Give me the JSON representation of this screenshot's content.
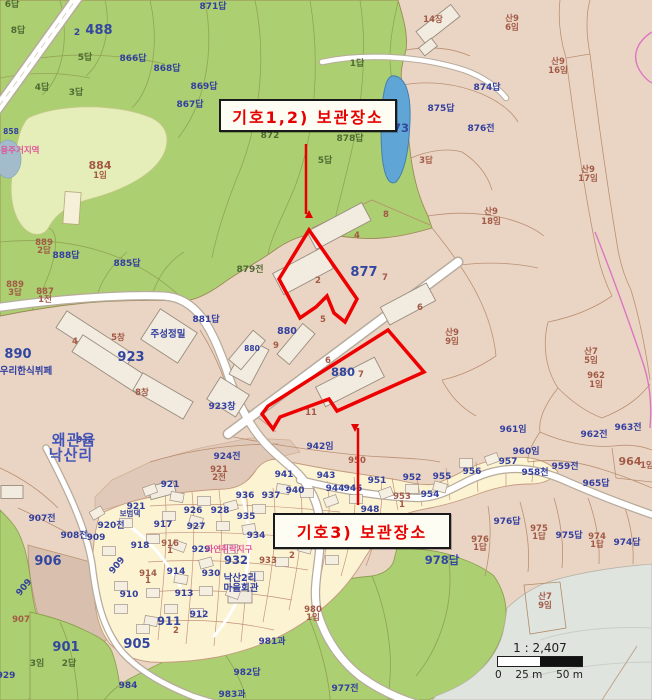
{
  "map": {
    "highlight_color": "#ee0000",
    "annotations": {
      "box1": {
        "text": "기호1,2) 보관장소",
        "x": 219,
        "y": 99,
        "w": 174,
        "h": 29
      },
      "box2": {
        "text": "기호3) 보관장소",
        "x": 273,
        "y": 513,
        "w": 174,
        "h": 32
      },
      "arrow_color": "#e60000",
      "arrows": [
        {
          "x1": 306,
          "y1": 144,
          "x2": 306,
          "y2": 214
        },
        {
          "x1": 358,
          "y1": 505,
          "x2": 358,
          "y2": 428
        }
      ]
    },
    "highlights": [
      {
        "name": "storage-site-1-2",
        "points": "309,230 357,299 345,322 334,313 327,296 316,307 300,318 279,279"
      },
      {
        "name": "storage-site-3",
        "points": "388,330 424,372 337,411 329,399 280,417 273,429 262,414 268,406"
      }
    ],
    "scale_bar": {
      "ratio": "1 : 2,407",
      "tick0": "0",
      "tick25": "25 m",
      "tick50": "50 m"
    },
    "colors": {
      "base_tan": "#ead5c5",
      "forest_green": "#accf72",
      "light_green": "#e5edb8",
      "village_cream": "#fbf3d2",
      "pond_blue": "#5fa5d5",
      "gray_zone": "#e0e4df",
      "parcel_line": "#b5896a",
      "label_blue": "#333f9e",
      "label_brown": "#a25a46",
      "zone_pink": "#e0559a",
      "road_white": "#ffffff"
    },
    "labels": [
      {
        "t": "6답",
        "x": 12,
        "y": 7,
        "c": "o"
      },
      {
        "t": "8답",
        "x": 18,
        "y": 33,
        "c": "o"
      },
      {
        "t": "2",
        "x": 77,
        "y": 35,
        "c": "b"
      },
      {
        "t": "488",
        "x": 99,
        "y": 34,
        "c": "B"
      },
      {
        "t": "866답",
        "x": 133,
        "y": 61,
        "c": "b"
      },
      {
        "t": "868답",
        "x": 167,
        "y": 71,
        "c": "b"
      },
      {
        "t": "871답",
        "x": 213,
        "y": 9,
        "c": "b"
      },
      {
        "t": "869답",
        "x": 204,
        "y": 89,
        "c": "b"
      },
      {
        "t": "867답",
        "x": 190,
        "y": 107,
        "c": "b"
      },
      {
        "t": "5답",
        "x": 85,
        "y": 60,
        "c": "o"
      },
      {
        "t": "4답",
        "x": 42,
        "y": 90,
        "c": "o"
      },
      {
        "t": "3답",
        "x": 76,
        "y": 95,
        "c": "o"
      },
      {
        "t": "858",
        "x": 11,
        "y": 134,
        "c": "t"
      },
      {
        "t": "전용주거지역",
        "x": 16,
        "y": 153,
        "c": "p"
      },
      {
        "t": "884",
        "x": 100,
        "y": 169,
        "c": "R"
      },
      {
        "t": "1임",
        "x": 100,
        "y": 178,
        "c": "r"
      },
      {
        "t": "1답",
        "x": 357,
        "y": 66,
        "c": "o"
      },
      {
        "t": "872",
        "x": 270,
        "y": 138,
        "c": "o"
      },
      {
        "t": "878답",
        "x": 350,
        "y": 141,
        "c": "o"
      },
      {
        "t": "5답",
        "x": 325,
        "y": 163,
        "c": "o"
      },
      {
        "t": "879전",
        "x": 250,
        "y": 272,
        "c": "o"
      },
      {
        "t": "889",
        "x": 44,
        "y": 245,
        "c": "r"
      },
      {
        "t": "2답",
        "x": 44,
        "y": 253,
        "c": "r"
      },
      {
        "t": "888답",
        "x": 66,
        "y": 258,
        "c": "b"
      },
      {
        "t": "885답",
        "x": 127,
        "y": 266,
        "c": "b"
      },
      {
        "t": "889",
        "x": 15,
        "y": 287,
        "c": "r"
      },
      {
        "t": "3답",
        "x": 15,
        "y": 295,
        "c": "r"
      },
      {
        "t": "887",
        "x": 45,
        "y": 294,
        "c": "r"
      },
      {
        "t": "1전",
        "x": 45,
        "y": 302,
        "c": "r"
      },
      {
        "t": "890",
        "x": 18,
        "y": 358,
        "c": "B"
      },
      {
        "t": "우리한식뷔페",
        "x": 26,
        "y": 374,
        "c": "w"
      },
      {
        "t": "14장",
        "x": 433,
        "y": 22,
        "c": "r"
      },
      {
        "t": "산9",
        "x": 512,
        "y": 21,
        "c": "r"
      },
      {
        "t": "6임",
        "x": 512,
        "y": 30,
        "c": "r"
      },
      {
        "t": "산9",
        "x": 558,
        "y": 64,
        "c": "r"
      },
      {
        "t": "16임",
        "x": 558,
        "y": 73,
        "c": "r"
      },
      {
        "t": "산9",
        "x": 588,
        "y": 172,
        "c": "r"
      },
      {
        "t": "17임",
        "x": 588,
        "y": 181,
        "c": "r"
      },
      {
        "t": "874답",
        "x": 487,
        "y": 90,
        "c": "b"
      },
      {
        "t": "875답",
        "x": 441,
        "y": 111,
        "c": "b"
      },
      {
        "t": "876전",
        "x": 481,
        "y": 131,
        "c": "b"
      },
      {
        "t": "873",
        "x": 397,
        "y": 132,
        "c": "B2"
      },
      {
        "t": "3답",
        "x": 426,
        "y": 163,
        "c": "r"
      },
      {
        "t": "산9",
        "x": 491,
        "y": 214,
        "c": "r"
      },
      {
        "t": "18임",
        "x": 491,
        "y": 224,
        "c": "r"
      },
      {
        "t": "산7",
        "x": 591,
        "y": 354,
        "c": "r"
      },
      {
        "t": "5임",
        "x": 591,
        "y": 363,
        "c": "r"
      },
      {
        "t": "8",
        "x": 386,
        "y": 217,
        "c": "r"
      },
      {
        "t": "4",
        "x": 357,
        "y": 238,
        "c": "r"
      },
      {
        "t": "2",
        "x": 318,
        "y": 283,
        "c": "r"
      },
      {
        "t": "877",
        "x": 364,
        "y": 276,
        "c": "B"
      },
      {
        "t": "7",
        "x": 385,
        "y": 280,
        "c": "r"
      },
      {
        "t": "5",
        "x": 323,
        "y": 322,
        "c": "r"
      },
      {
        "t": "6",
        "x": 420,
        "y": 310,
        "c": "r"
      },
      {
        "t": "880",
        "x": 287,
        "y": 334,
        "c": "w"
      },
      {
        "t": "880",
        "x": 252,
        "y": 351,
        "c": "t"
      },
      {
        "t": "9",
        "x": 276,
        "y": 348,
        "c": "r"
      },
      {
        "t": "881답",
        "x": 206,
        "y": 322,
        "c": "b"
      },
      {
        "t": "923",
        "x": 131,
        "y": 361,
        "c": "B"
      },
      {
        "t": "주성정밀",
        "x": 168,
        "y": 337,
        "c": "w"
      },
      {
        "t": "4",
        "x": 75,
        "y": 344,
        "c": "r"
      },
      {
        "t": "5창",
        "x": 118,
        "y": 340,
        "c": "r"
      },
      {
        "t": "8창",
        "x": 142,
        "y": 395,
        "c": "r"
      },
      {
        "t": "923창",
        "x": 222,
        "y": 409,
        "c": "b"
      },
      {
        "t": "880",
        "x": 343,
        "y": 376,
        "c": "B2"
      },
      {
        "t": "7",
        "x": 361,
        "y": 377,
        "c": "r"
      },
      {
        "t": "6",
        "x": 328,
        "y": 363,
        "c": "r"
      },
      {
        "t": "11",
        "x": 311,
        "y": 415,
        "c": "r"
      },
      {
        "t": "942임",
        "x": 320,
        "y": 449,
        "c": "b"
      },
      {
        "t": "산9",
        "x": 452,
        "y": 335,
        "c": "r"
      },
      {
        "t": "9임",
        "x": 452,
        "y": 344,
        "c": "r"
      },
      {
        "t": "962",
        "x": 596,
        "y": 378,
        "c": "r"
      },
      {
        "t": "1임",
        "x": 596,
        "y": 387,
        "c": "r"
      },
      {
        "t": "962전",
        "x": 594,
        "y": 437,
        "c": "b"
      },
      {
        "t": "963전",
        "x": 628,
        "y": 430,
        "c": "b"
      },
      {
        "t": "964",
        "x": 630,
        "y": 465,
        "c": "R"
      },
      {
        "t": "1임",
        "x": 647,
        "y": 468,
        "c": "r"
      },
      {
        "t": "965답",
        "x": 596,
        "y": 486,
        "c": "b"
      },
      {
        "t": "959전",
        "x": 565,
        "y": 469,
        "c": "b"
      },
      {
        "t": "960임",
        "x": 526,
        "y": 454,
        "c": "b"
      },
      {
        "t": "961임",
        "x": 513,
        "y": 432,
        "c": "b"
      },
      {
        "t": "957",
        "x": 508,
        "y": 464,
        "c": "b"
      },
      {
        "t": "958천",
        "x": 535,
        "y": 475,
        "c": "b"
      },
      {
        "t": "956",
        "x": 472,
        "y": 474,
        "c": "b"
      },
      {
        "t": "955",
        "x": 442,
        "y": 479,
        "c": "b"
      },
      {
        "t": "954",
        "x": 430,
        "y": 497,
        "c": "b"
      },
      {
        "t": "952",
        "x": 412,
        "y": 480,
        "c": "b"
      },
      {
        "t": "953",
        "x": 402,
        "y": 499,
        "c": "r"
      },
      {
        "t": "1",
        "x": 402,
        "y": 507,
        "c": "r"
      },
      {
        "t": "951",
        "x": 377,
        "y": 483,
        "c": "b"
      },
      {
        "t": "950",
        "x": 357,
        "y": 463,
        "c": "r"
      },
      {
        "t": "948",
        "x": 370,
        "y": 512,
        "c": "b"
      },
      {
        "t": "945",
        "x": 353,
        "y": 491,
        "c": "b"
      },
      {
        "t": "944",
        "x": 335,
        "y": 491,
        "c": "b"
      },
      {
        "t": "943",
        "x": 326,
        "y": 478,
        "c": "b"
      },
      {
        "t": "941",
        "x": 284,
        "y": 477,
        "c": "b"
      },
      {
        "t": "940",
        "x": 295,
        "y": 493,
        "c": "b"
      },
      {
        "t": "937",
        "x": 271,
        "y": 498,
        "c": "b"
      },
      {
        "t": "936",
        "x": 245,
        "y": 498,
        "c": "b"
      },
      {
        "t": "935",
        "x": 246,
        "y": 519,
        "c": "b"
      },
      {
        "t": "934",
        "x": 256,
        "y": 538,
        "c": "b"
      },
      {
        "t": "939",
        "x": 289,
        "y": 541,
        "c": "b"
      },
      {
        "t": "928",
        "x": 220,
        "y": 513,
        "c": "b"
      },
      {
        "t": "926",
        "x": 193,
        "y": 513,
        "c": "b"
      },
      {
        "t": "927",
        "x": 196,
        "y": 529,
        "c": "b"
      },
      {
        "t": "917",
        "x": 163,
        "y": 527,
        "c": "b"
      },
      {
        "t": "916",
        "x": 170,
        "y": 546,
        "c": "r"
      },
      {
        "t": "1",
        "x": 170,
        "y": 553,
        "c": "r"
      },
      {
        "t": "918",
        "x": 140,
        "y": 548,
        "c": "b"
      },
      {
        "t": "929",
        "x": 201,
        "y": 552,
        "c": "b"
      },
      {
        "t": "자연취락지구",
        "x": 229,
        "y": 552,
        "c": "p"
      },
      {
        "t": "932",
        "x": 236,
        "y": 564,
        "c": "B2"
      },
      {
        "t": "933",
        "x": 268,
        "y": 563,
        "c": "r"
      },
      {
        "t": "2",
        "x": 292,
        "y": 558,
        "c": "r"
      },
      {
        "t": "930",
        "x": 211,
        "y": 576,
        "c": "b"
      },
      {
        "t": "낙산2리",
        "x": 240,
        "y": 581,
        "c": "w"
      },
      {
        "t": "마을회관",
        "x": 241,
        "y": 591,
        "c": "w"
      },
      {
        "t": "914",
        "x": 148,
        "y": 576,
        "c": "r"
      },
      {
        "t": "1",
        "x": 148,
        "y": 583,
        "c": "r"
      },
      {
        "t": "914",
        "x": 176,
        "y": 574,
        "c": "b"
      },
      {
        "t": "913",
        "x": 184,
        "y": 596,
        "c": "b"
      },
      {
        "t": "910",
        "x": 129,
        "y": 597,
        "c": "b"
      },
      {
        "t": "912",
        "x": 199,
        "y": 617,
        "c": "b"
      },
      {
        "t": "911",
        "x": 169,
        "y": 625,
        "c": "B2"
      },
      {
        "t": "2",
        "x": 176,
        "y": 633,
        "c": "r"
      },
      {
        "t": "905",
        "x": 137,
        "y": 648,
        "c": "B"
      },
      {
        "t": "907",
        "x": 21,
        "y": 622,
        "c": "r"
      },
      {
        "t": "906",
        "x": 48,
        "y": 565,
        "c": "B"
      },
      {
        "t": "924전",
        "x": 227,
        "y": 459,
        "c": "b"
      },
      {
        "t": "921",
        "x": 219,
        "y": 472,
        "c": "r"
      },
      {
        "t": "2전",
        "x": 219,
        "y": 480,
        "c": "r"
      },
      {
        "t": "921",
        "x": 170,
        "y": 487,
        "c": "b"
      },
      {
        "t": "921",
        "x": 136,
        "y": 509,
        "c": "b"
      },
      {
        "t": "보범댁",
        "x": 130,
        "y": 516,
        "c": "t"
      },
      {
        "t": "932",
        "x": 85,
        "y": 442,
        "c": "t"
      },
      {
        "t": "왜관읍",
        "x": 74,
        "y": 445,
        "c": "P"
      },
      {
        "t": "낙산리",
        "x": 71,
        "y": 460,
        "c": "P"
      },
      {
        "t": "907전",
        "x": 42,
        "y": 521,
        "c": "b"
      },
      {
        "t": "908전",
        "x": 74,
        "y": 538,
        "c": "b"
      },
      {
        "t": "909",
        "x": 96,
        "y": 540,
        "c": "b"
      },
      {
        "t": "920전",
        "x": 111,
        "y": 528,
        "c": "b"
      },
      {
        "t": "909",
        "x": 119,
        "y": 567,
        "c": "b",
        "r": -50
      },
      {
        "t": "909",
        "x": 26,
        "y": 589,
        "c": "b",
        "r": -50
      },
      {
        "t": "901",
        "x": 66,
        "y": 651,
        "c": "B"
      },
      {
        "t": "2답",
        "x": 69,
        "y": 666,
        "c": "o"
      },
      {
        "t": "3임",
        "x": 37,
        "y": 666,
        "c": "o"
      },
      {
        "t": "929",
        "x": 6,
        "y": 678,
        "c": "b"
      },
      {
        "t": "984",
        "x": 128,
        "y": 688,
        "c": "b"
      },
      {
        "t": "982답",
        "x": 247,
        "y": 675,
        "c": "b"
      },
      {
        "t": "983과",
        "x": 232,
        "y": 697,
        "c": "b"
      },
      {
        "t": "981과",
        "x": 272,
        "y": 644,
        "c": "b"
      },
      {
        "t": "980",
        "x": 313,
        "y": 612,
        "c": "r"
      },
      {
        "t": "1임",
        "x": 313,
        "y": 620,
        "c": "r"
      },
      {
        "t": "978답",
        "x": 442,
        "y": 564,
        "c": "B2"
      },
      {
        "t": "977전",
        "x": 345,
        "y": 691,
        "c": "b"
      },
      {
        "t": "산7",
        "x": 545,
        "y": 599,
        "c": "r"
      },
      {
        "t": "9임",
        "x": 545,
        "y": 608,
        "c": "r"
      },
      {
        "t": "976답",
        "x": 507,
        "y": 524,
        "c": "b"
      },
      {
        "t": "976",
        "x": 480,
        "y": 542,
        "c": "r"
      },
      {
        "t": "1답",
        "x": 480,
        "y": 550,
        "c": "r"
      },
      {
        "t": "975답",
        "x": 569,
        "y": 538,
        "c": "b"
      },
      {
        "t": "975",
        "x": 539,
        "y": 531,
        "c": "r"
      },
      {
        "t": "1답",
        "x": 539,
        "y": 539,
        "c": "r"
      },
      {
        "t": "974답",
        "x": 627,
        "y": 545,
        "c": "b"
      },
      {
        "t": "974",
        "x": 597,
        "y": 539,
        "c": "r"
      },
      {
        "t": "1답",
        "x": 597,
        "y": 547,
        "c": "r"
      }
    ]
  }
}
